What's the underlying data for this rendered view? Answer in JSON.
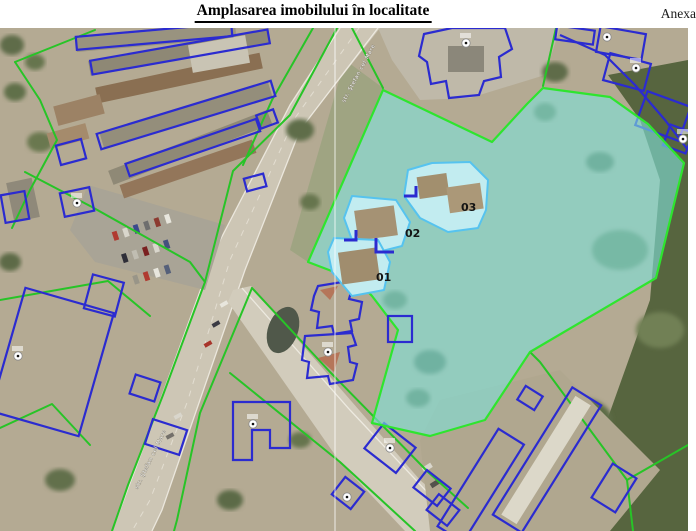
{
  "page": {
    "title": "Amplasarea imobilului în localitate",
    "annex": "Anexa"
  },
  "map": {
    "parcel_labels": [
      {
        "id": "01"
      },
      {
        "id": "02"
      },
      {
        "id": "03"
      }
    ],
    "street_labels": [
      "str. Ştefan cel Mare",
      "str. Ştefan cel Mare"
    ],
    "colors": {
      "highlight_fill": "#7fe0d8",
      "highlight_stroke": "#2ee52e",
      "cadastral_line": "#27c427",
      "building_outline": "#2b2bd0",
      "inner_building_stroke": "#56c3ef",
      "inner_building_fill": "#c2ecf0"
    }
  }
}
